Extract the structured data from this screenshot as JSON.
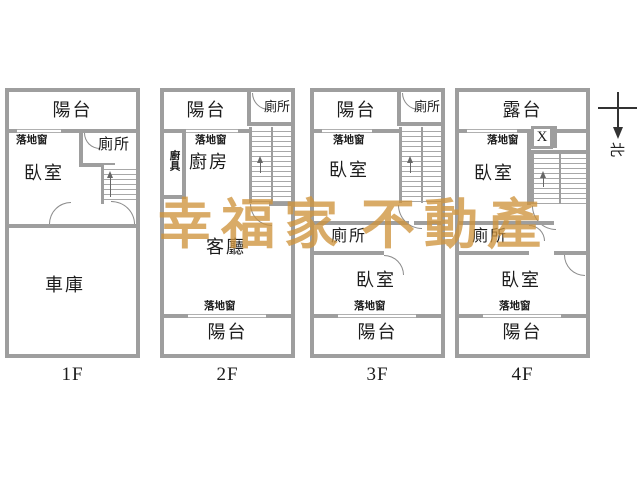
{
  "watermark": {
    "part1": "幸福家",
    "part2": "不動產",
    "color": "#ce943c"
  },
  "compass": {
    "north_label": "北"
  },
  "colors": {
    "wall": "#9e9e9e",
    "text": "#1c1c1c"
  },
  "floors": [
    {
      "label": "1F",
      "rooms": {
        "balcony": "陽台",
        "window": "落地窗",
        "toilet": "廁所",
        "bedroom": "臥室",
        "garage": "車庫"
      }
    },
    {
      "label": "2F",
      "rooms": {
        "balcony_top": "陽台",
        "toilet": "廁所",
        "window_top": "落地窗",
        "cabinet": "廚具",
        "kitchen": "廚房",
        "living_room": "客廳",
        "window_bottom": "落地窗",
        "balcony_bottom": "陽台"
      }
    },
    {
      "label": "3F",
      "rooms": {
        "balcony_top": "陽台",
        "toilet_top": "廁所",
        "window_top": "落地窗",
        "bedroom_top": "臥室",
        "toilet_middle": "廁所",
        "bedroom_bottom": "臥室",
        "window_bottom": "落地窗",
        "balcony_bottom": "陽台"
      }
    },
    {
      "label": "4F",
      "rooms": {
        "terrace": "露台",
        "window_top": "落地窗",
        "void_mark": "X",
        "bedroom_top": "臥室",
        "toilet_middle": "廁所",
        "bedroom_bottom": "臥室",
        "window_bottom": "落地窗",
        "balcony_bottom": "陽台"
      }
    }
  ]
}
